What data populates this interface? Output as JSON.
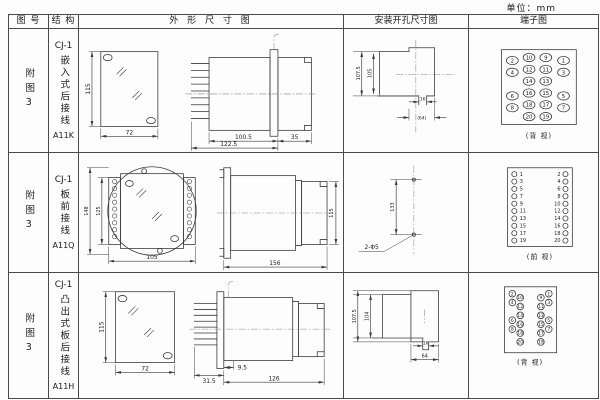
{
  "unit_label": "单位：mm",
  "header": {
    "fig": "图 号",
    "struct": "结 构",
    "outline": "外 形 尺 寸 图",
    "install": "安装开孔尺寸图",
    "terminal": "端子图"
  },
  "rows": [
    {
      "fig": "附图3",
      "struct": {
        "model": "CJ-1",
        "desc": "嵌入式后接线",
        "code": "A11K"
      },
      "outline": {
        "front_height": "115",
        "front_width": "72",
        "body_length": "100.5",
        "total_length": "122.5",
        "rear_length": "35"
      },
      "install": {
        "outer_height": "107.5",
        "inner_height": "105",
        "notch_width": "16",
        "cutout_width": "(64)"
      },
      "terminal": {
        "view": "(背 视)",
        "grid": [
          [
            "2",
            "10",
            "9",
            "1"
          ],
          [
            "4",
            "12",
            "11",
            "3"
          ],
          [
            "14",
            "13"
          ],
          [
            "6",
            "16",
            "15",
            "5"
          ],
          [
            "8",
            "18",
            "17",
            "7"
          ],
          [
            "20",
            "19"
          ]
        ]
      }
    },
    {
      "fig": "附图3",
      "struct": {
        "model": "CJ-1",
        "desc": "板前接线",
        "code": "A11Q"
      },
      "outline": {
        "front_outer_height": "148",
        "front_inner_height": "125",
        "front_width": "105",
        "side_length": "156",
        "side_height": "115"
      },
      "install": {
        "hole_spacing": "133",
        "holes": "2-Φ5"
      },
      "terminal": {
        "view": "(前 视)",
        "left": [
          "1",
          "3",
          "5",
          "7",
          "9",
          "11",
          "13",
          "15",
          "17",
          "19"
        ],
        "right": [
          "2",
          "4",
          "6",
          "8",
          "10",
          "12",
          "14",
          "16",
          "18",
          "20"
        ]
      }
    },
    {
      "fig": "附图3",
      "struct": {
        "model": "CJ-1",
        "desc": "凸出式板后接线",
        "code": "A11H"
      },
      "outline": {
        "front_height": "115",
        "front_width": "72",
        "pin_length": "31.5",
        "flange_offset": "9.5",
        "body_length": "126"
      },
      "install": {
        "outer_height": "107.5",
        "inner_height": "104",
        "notch_width": "16",
        "cutout_width": "64"
      },
      "terminal": {
        "view": "(背 视)",
        "grid": [
          [
            "2",
            "10",
            "9",
            "1"
          ],
          [
            "4",
            "12",
            "11",
            "3"
          ],
          [
            "14",
            "13"
          ],
          [
            "6",
            "16",
            "15",
            "5"
          ],
          [
            "8",
            "18",
            "17",
            "7"
          ],
          [
            "20",
            "19"
          ]
        ]
      }
    }
  ]
}
